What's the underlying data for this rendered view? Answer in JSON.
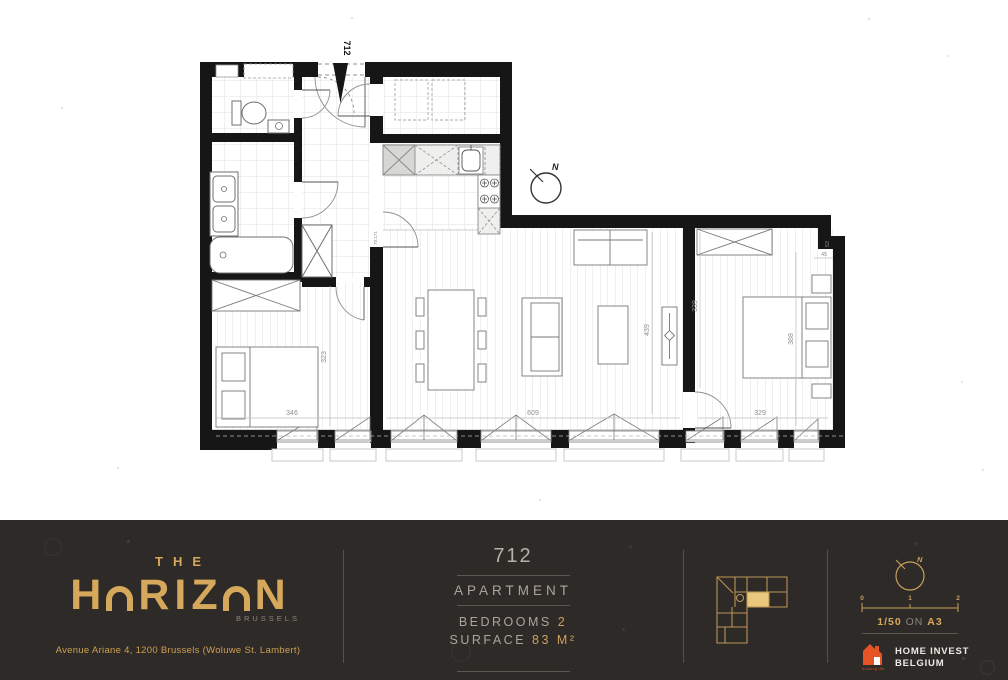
{
  "plan": {
    "entry_unit_label": "712",
    "north_label": "N",
    "door_label": "70.171",
    "dims": {
      "bedroom1_w": "346",
      "bedroom1_d": "323",
      "living_w": "609",
      "living_d": "439",
      "bedroom2_left": "339",
      "bedroom2_w": "329",
      "bedroom2_right": "388",
      "notch_v": "52",
      "notch_h": "45"
    }
  },
  "footer": {
    "brand": {
      "the": "THE",
      "letters": [
        "H",
        "O",
        "R",
        "I",
        "Z",
        "O",
        "N"
      ],
      "city": "BRUSSELS",
      "address": "Avenue Ariane 4, 1200 Brussels (Woluwe St. Lambert)"
    },
    "unit": {
      "number": "712",
      "type": "APARTMENT",
      "bedrooms_label": "BEDROOMS",
      "bedrooms_value": "2",
      "surface_label": "SURFACE",
      "surface_value": "83 M²"
    },
    "map": {
      "north_label": "N",
      "scale_ticks": [
        "0",
        "1",
        "2"
      ],
      "scale_ratio": "1/50",
      "scale_on": "ON",
      "scale_paper": "A3"
    },
    "publisher": {
      "name_line1": "HOME INVEST",
      "name_line2": "BELGIUM",
      "tagline": "housing life"
    }
  },
  "colors": {
    "gold": "#d6a85c",
    "footer_bg": "#2e2a27",
    "orange": "#e65426",
    "wall_black": "#161616"
  }
}
